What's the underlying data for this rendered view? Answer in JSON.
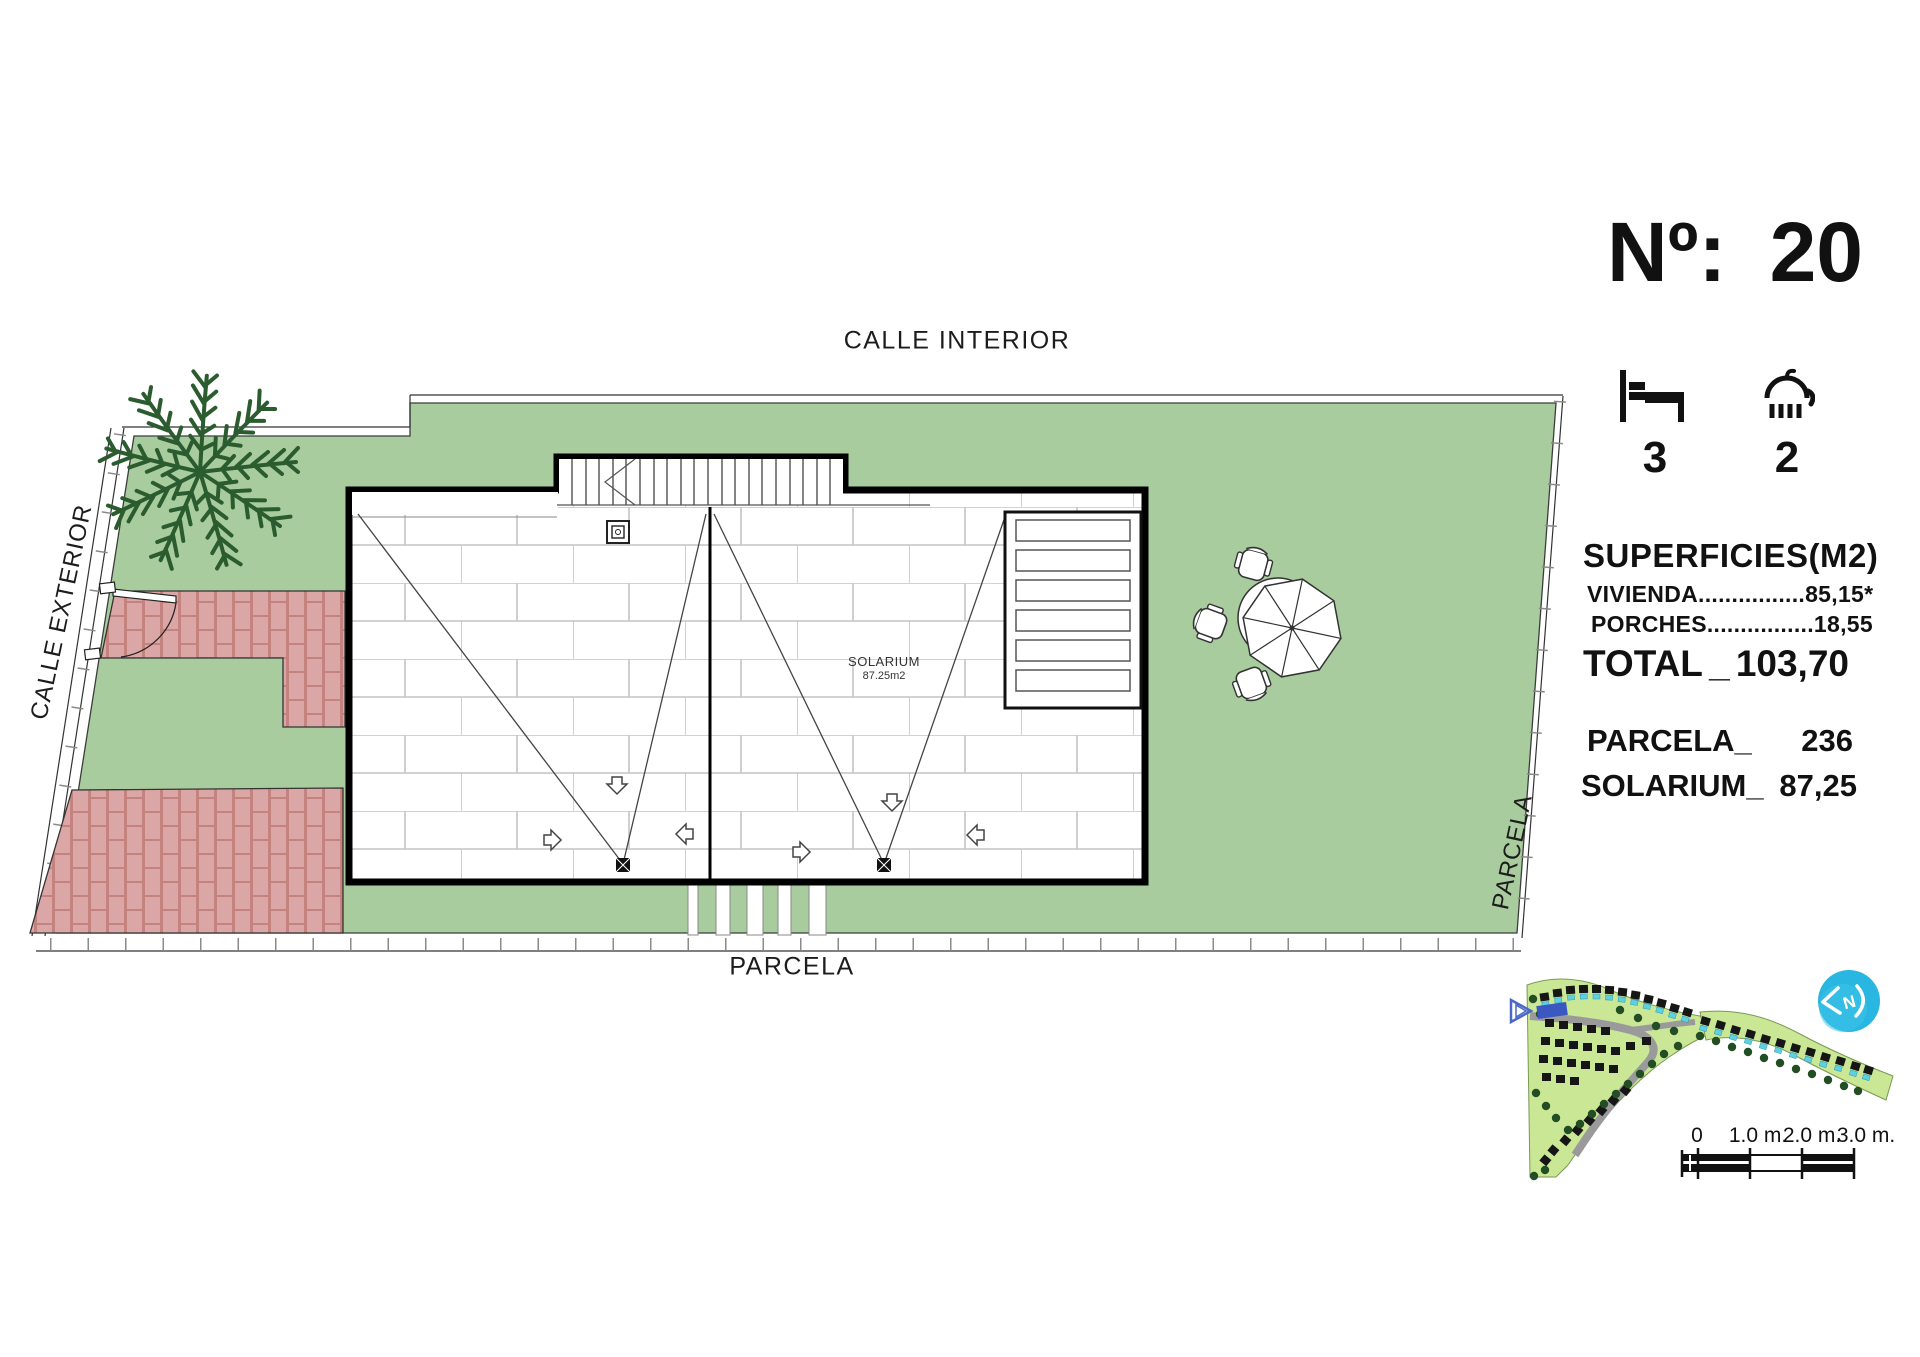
{
  "header": {
    "number_label": "Nº:",
    "number_value": "20"
  },
  "features": {
    "bedrooms": "3",
    "bathrooms": "2"
  },
  "areas": {
    "title": "SUPERFICIES(M2)",
    "rows": [
      {
        "label": "VIVIENDA",
        "dots": "................",
        "value": "85,15*"
      },
      {
        "label": "PORCHES",
        "dots": "................",
        "value": "18,55"
      }
    ],
    "total_label": "TOTAL",
    "total_sep": "_",
    "total_value": "103,70",
    "parcela_label": "PARCELA_",
    "parcela_value": "236",
    "solarium_label": "SOLARIUM_",
    "solarium_value": "87,25"
  },
  "plan": {
    "street_top": "CALLE INTERIOR",
    "street_left": "CALLE EXTERIOR",
    "parcela_bottom": "PARCELA",
    "parcela_right": "PARCELA",
    "solarium_label": "SOLARIUM",
    "solarium_area": "87.25m2"
  },
  "scalebar": {
    "tick0": "0",
    "tick1": "1.0 m.",
    "tick2": "2.0 m.",
    "tick3": "3.0 m."
  },
  "colors": {
    "lawn": "#a9cc9f",
    "brick": "#dba6a6",
    "brick_joint": "#c5837f",
    "palm": "#2b5c2f",
    "logo": "#29b6e0",
    "highlight_villa": "#3a57c2",
    "minimap_green": "#c9e794",
    "pool": "#5fd0e0"
  }
}
